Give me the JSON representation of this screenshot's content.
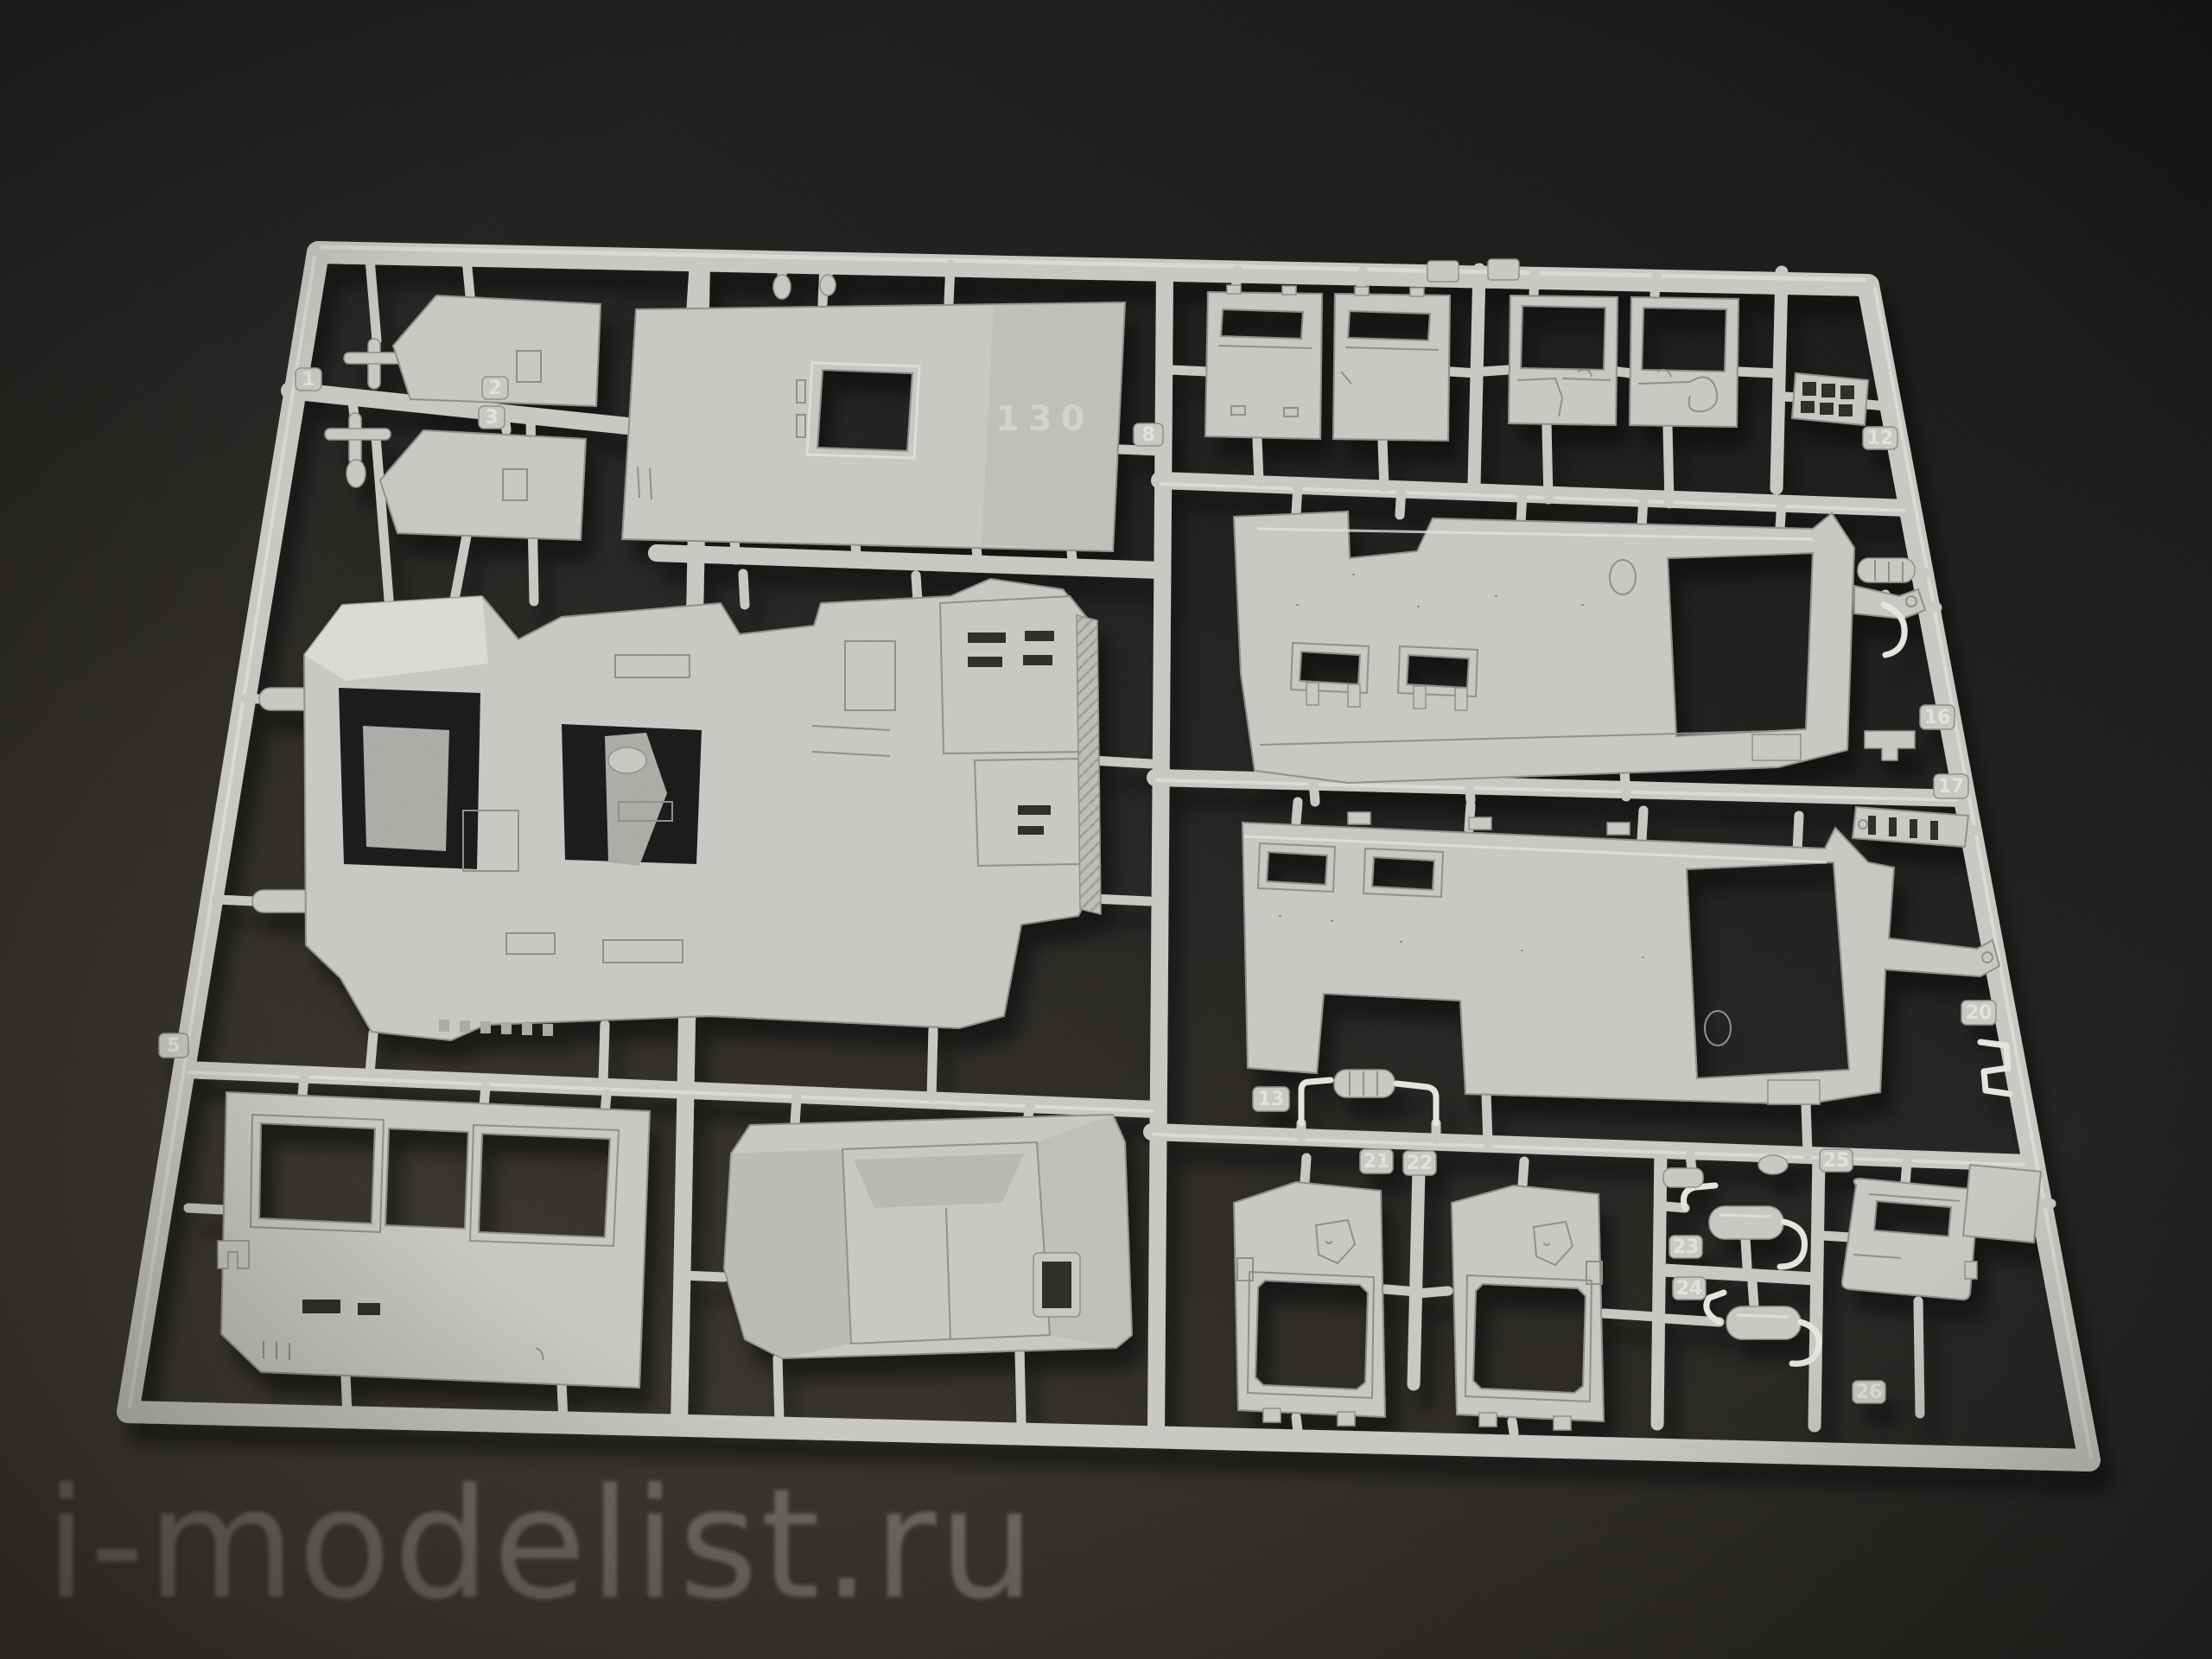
{
  "watermark": {
    "text": "i-modelist.ru"
  },
  "sprue": {
    "description": "grey injection-molded model kit sprue with vehicle body parts on dark background",
    "roof_marking": "130",
    "part_tags": [
      {
        "number": "1"
      },
      {
        "number": "2"
      },
      {
        "number": "3"
      },
      {
        "number": "5"
      },
      {
        "number": "8"
      },
      {
        "number": "12"
      },
      {
        "number": "13"
      },
      {
        "number": "16"
      },
      {
        "number": "17"
      },
      {
        "number": "20"
      },
      {
        "number": "21"
      },
      {
        "number": "22"
      },
      {
        "number": "23"
      },
      {
        "number": "24"
      },
      {
        "number": "25"
      },
      {
        "number": "26"
      }
    ]
  },
  "colors": {
    "bg-dark": "#141312",
    "bg-mid": "#242220",
    "bg-light": "#34312c",
    "plastic": "#c7c7c3",
    "plastic-light": "#e4e4e0",
    "plastic-dark": "#abaaa6",
    "plastic-deep": "#8d8d89",
    "hole": "#161513",
    "watermark": "#98958f"
  }
}
